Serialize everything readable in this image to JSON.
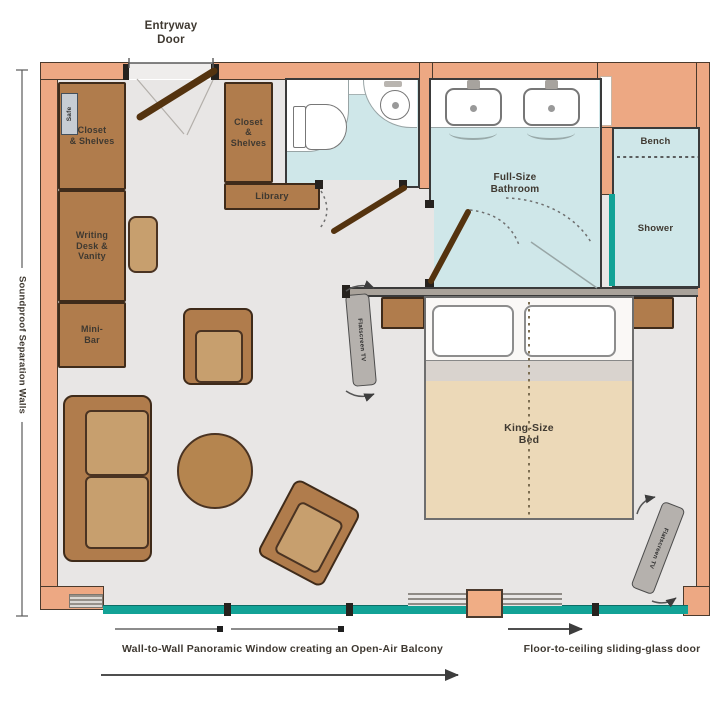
{
  "labels": {
    "entryway_door": "Entryway\nDoor",
    "soundproof_walls": "Soundproof Separation Walls",
    "safe": "Safe",
    "closet_shelves_left": "Closet\n& Shelves",
    "writing_desk_vanity": "Writing\nDesk &\nVanity",
    "mini_bar": "Mini-\nBar",
    "closet_shelves_mid": "Closet\n&\nShelves",
    "library": "Library",
    "full_size_bathroom": "Full-Size\nBathroom",
    "bench": "Bench",
    "shower": "Shower",
    "king_size_bed": "King-Size\nBed",
    "flatscreen_tv_bed": "Flatscreen TV",
    "flatscreen_tv_corner": "Flatscreen TV",
    "window_caption": "Wall-to-Wall Panoramic Window creating an Open-Air Balcony",
    "sliding_door_caption": "Floor-to-ceiling sliding-glass door"
  },
  "colors": {
    "wall": "#eda883",
    "floor": "#e8e6e5",
    "furniture_brown": "#b07c4c",
    "furniture_light": "#c79f6e",
    "bathroom_floor": "#cfe7e9",
    "glass_teal": "#12a296",
    "bed_duvet": "#ecd9b8",
    "text": "#3f3931"
  }
}
